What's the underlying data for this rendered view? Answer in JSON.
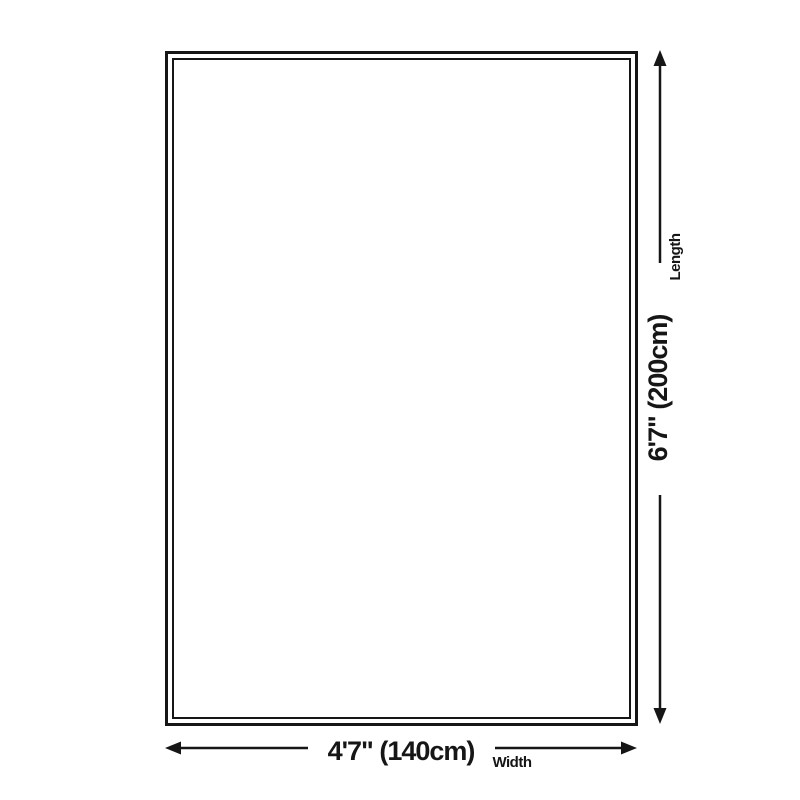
{
  "diagram": {
    "length": {
      "label": "Length",
      "value": "6'7\" (200cm)"
    },
    "width": {
      "label": "Width",
      "value": "4'7\" (140cm)"
    }
  },
  "colors": {
    "line": "#161616",
    "background": "#ffffff"
  }
}
